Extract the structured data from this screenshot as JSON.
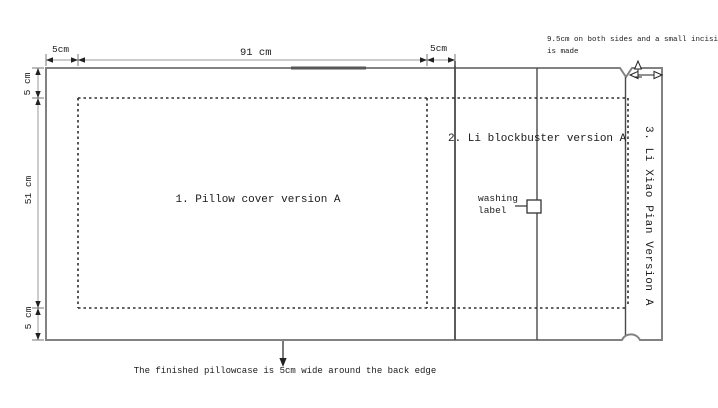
{
  "diagram": {
    "type": "sewing-pattern-diagram",
    "sections": {
      "pillow_cover": {
        "label": "1. Pillow cover version A"
      },
      "blockbuster": {
        "label": "2. Li blockbuster version A"
      },
      "xiao_pian": {
        "label": "3. Li Xiao Pian Version A"
      }
    },
    "dimensions": {
      "top_left": "5cm",
      "top_width": "91 cm",
      "top_right": "5cm",
      "left_top": "5 cm",
      "left_height": "51 cm",
      "left_bottom": "5 cm"
    },
    "annotations": {
      "incision_note": "9.5cm on both sides and a small incision is made",
      "washing_label": "washing label",
      "bottom_note": "The finished pillowcase is 5cm wide around the back edge"
    },
    "colors": {
      "background": "#ffffff",
      "outer_border": "#828282",
      "inner_line": "#4a4a4a",
      "dotted_line": "#2e2e2e",
      "dimension_line": "#999999",
      "arrow": "#222222",
      "dark_top_segment": "#575757",
      "text": "#1b1b1b"
    }
  }
}
